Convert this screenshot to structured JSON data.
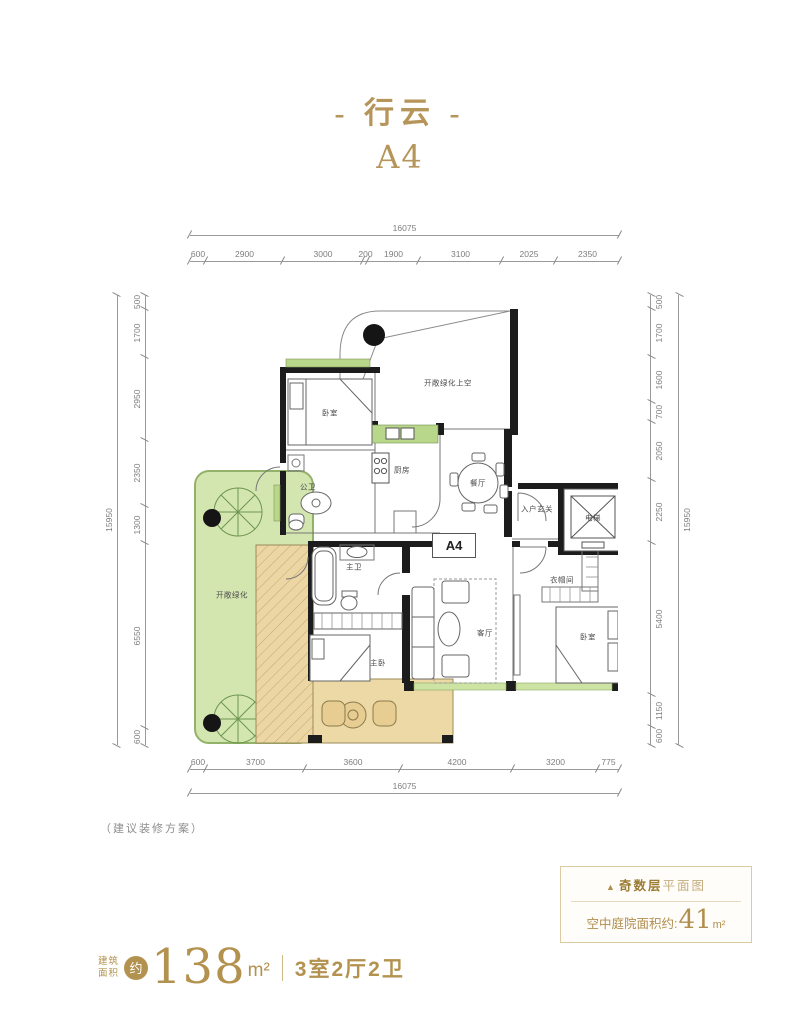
{
  "header": {
    "title": "- 行云 -",
    "unit": "A4"
  },
  "plan": {
    "rooms": {
      "bedroom_top": "卧室",
      "guest_bath": "公卫",
      "kitchen": "厨房",
      "dining": "餐厅",
      "void_above": "开敞绿化上空",
      "entry": "入户玄关",
      "elevator": "电梯",
      "cloakroom": "衣帽间",
      "master_bath": "主卫",
      "master_bedroom": "主卧",
      "living": "客厅",
      "bedroom_right": "卧室",
      "courtyard": "开敞绿化",
      "unit_tag": "A4"
    },
    "dims": {
      "top_total": "16075",
      "top": [
        "600",
        "2900",
        "3000",
        "200",
        "1900",
        "3100",
        "2025",
        "2350"
      ],
      "bottom": [
        "600",
        "3700",
        "3600",
        "4200",
        "3200",
        "775"
      ],
      "bottom_total": "16075",
      "left_total": "15950",
      "left": [
        "500",
        "1700",
        "2950",
        "2350",
        "1300",
        "6550",
        "600"
      ],
      "right": [
        "500",
        "1700",
        "1600",
        "700",
        "2050",
        "2250",
        "5400",
        "1150",
        "600"
      ],
      "right_total": "15950"
    }
  },
  "footer": {
    "note": "（建议装修方案）",
    "info_box": {
      "marker": "▲",
      "line1_bold": "奇数层",
      "line1_rest": "平面图",
      "line2_label": "空中庭院面积约:",
      "line2_value": "41",
      "line2_unit": "m²"
    },
    "area": {
      "label_line1": "建筑",
      "label_line2": "面积",
      "approx": "约",
      "value": "138",
      "unit": "m²",
      "layout": "3室2厅2卫"
    }
  },
  "colors": {
    "accent_gold": "#b3924f",
    "courtyard_green": "#d4e6b0",
    "window_green": "#b9d78b",
    "deck_tan": "#ecd6a4"
  }
}
